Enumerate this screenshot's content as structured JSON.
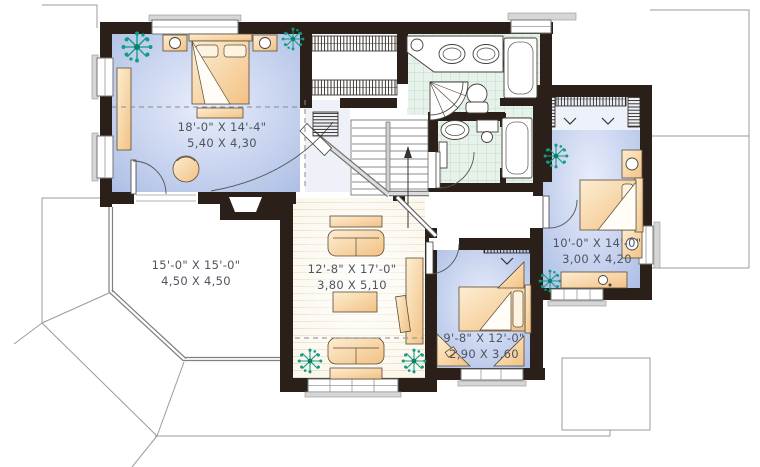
{
  "meta": {
    "type": "architectural-floor-plan",
    "units": "feet-and-meters"
  },
  "colors": {
    "wall": "#2a2019",
    "bedroom_floor": "#b9c7e9",
    "bathroom_tile": "#e7f3ea",
    "tile_grid": "#bfdccb",
    "furniture": "#f5cf96",
    "plant": "#109c85",
    "wood_floor": "#fbf7ec",
    "label_text": "#4e555f",
    "roof_line": "#9b9b9b",
    "railing": "#cfcfcf"
  },
  "rooms": [
    {
      "id": "master-bedroom",
      "imperial": "18'-0\" X 14'-4\"",
      "metric": "5,40 X 4,30"
    },
    {
      "id": "open-area",
      "imperial": "15'-0\" X 15'-0\"",
      "metric": "4,50 X 4,50"
    },
    {
      "id": "family-room",
      "imperial": "12'-8\" X 17'-0\"",
      "metric": "3,80 X 5,10"
    },
    {
      "id": "bedroom-2",
      "imperial": "10'-0\" X 14'-0\"",
      "metric": "3,00 X 4,20"
    },
    {
      "id": "bedroom-3",
      "imperial": "9'-8\" X 12'-0\"",
      "metric": "2,90 X 3,60"
    }
  ],
  "fixtures": [
    "double-sink-vanity",
    "corner-shower",
    "toilet",
    "water-closet-toilet",
    "bathtub-upper",
    "bathtub-lower",
    "staircase-up-arrow",
    "walk-in-closet-racks",
    "linen-closet",
    "beds",
    "nightstands-with-lamps",
    "sofas",
    "coffee-table",
    "media-desk",
    "dresser",
    "corner-desks",
    "plants",
    "armchair"
  ]
}
